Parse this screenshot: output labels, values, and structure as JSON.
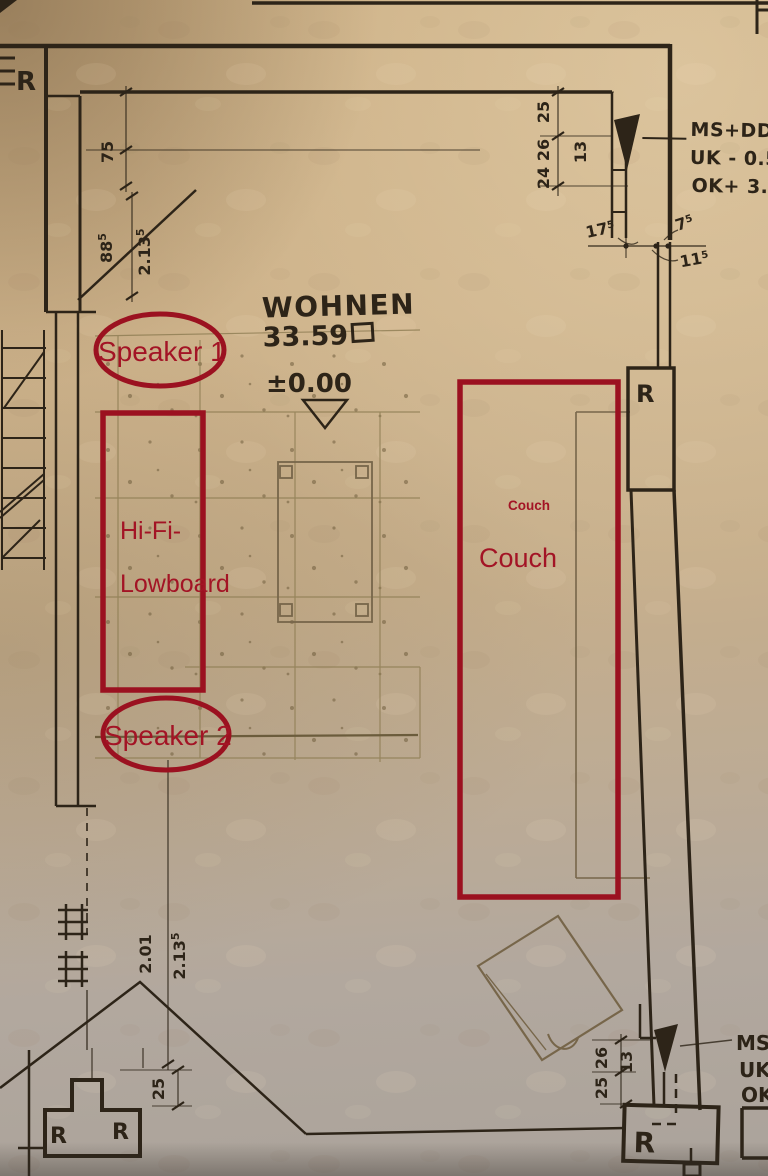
{
  "colors": {
    "ink": "#2d2418",
    "pencil": "#77664a",
    "tile": "#8d7c52",
    "annotation": "#9b1120",
    "annotation_text": "#a31425",
    "paper_top": "#cbae83",
    "paper_bottom": "#aba39b"
  },
  "room": {
    "name": "WOHNEN",
    "area": "33.59",
    "level": "±0.00"
  },
  "markers": {
    "r_top_left": "R",
    "r_heater_right": "R",
    "r_chimney_1": "R",
    "r_chimney_2": "R",
    "r_heater_bottom": "R"
  },
  "dims": {
    "wall_offset": "75",
    "stair_a_main": "88",
    "stair_a_sup": "5",
    "stair_b_main": "2.13",
    "stair_b_sup": "5",
    "chain_top": [
      "25",
      "26",
      "24"
    ],
    "wall13": "13",
    "j1_main": "17",
    "j1_sup": "5",
    "j2_main": "7",
    "j2_sup": "5",
    "j3_main": "11",
    "j3_sup": "5",
    "height_a": "2.01",
    "height_b_main": "2.13",
    "height_b_sup": "5",
    "chimney_offset": "25",
    "chain_bottom": [
      "26",
      "25"
    ],
    "wall13b": "13"
  },
  "levels_top": [
    "MS+DD",
    "UK - 0.50",
    "OK+ 3.50"
  ],
  "levels_bottom": [
    "MS",
    "UK",
    "OK"
  ],
  "annotations": {
    "speaker1": "Speaker 1",
    "speaker2": "Speaker 2",
    "hifi_line1": "Hi-Fi-",
    "hifi_line2": "Lowboard",
    "couch_small": "Couch",
    "couch_large": "Couch"
  }
}
